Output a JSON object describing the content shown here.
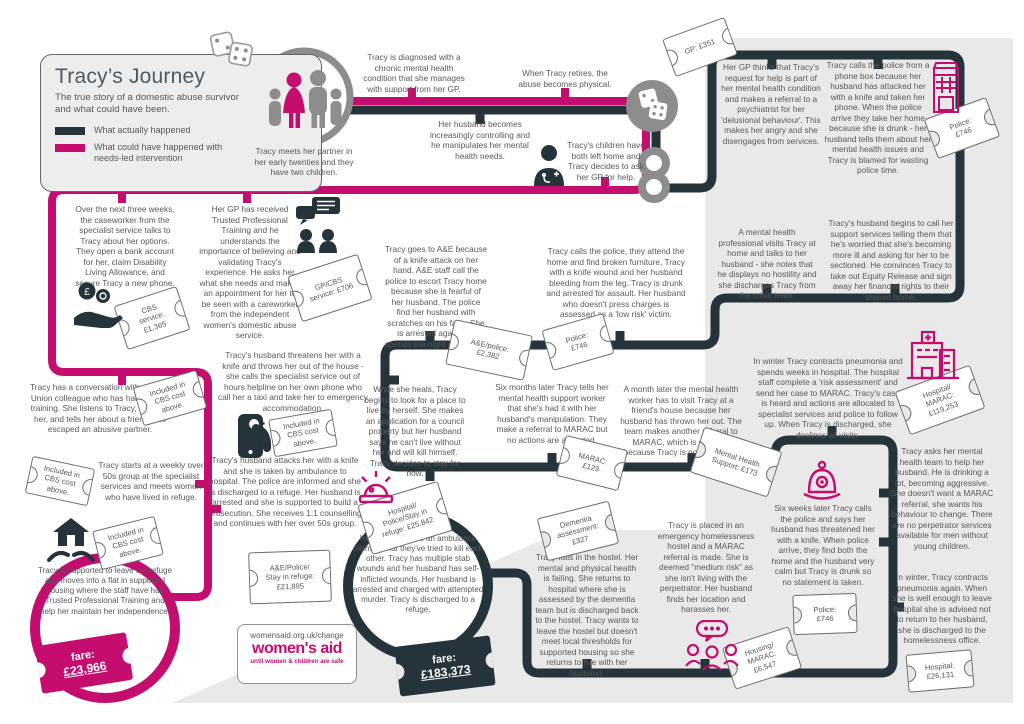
{
  "colors": {
    "dark": "#25333b",
    "pink": "#c40d6f",
    "gray": "#8d8d8d",
    "panel": "#e9e9e9",
    "text": "#57585a"
  },
  "header": {
    "title": "Tracy’s Journey",
    "subtitle": "The true story of a domestic abuse survivor and what could have been.",
    "legend": [
      {
        "label": "What actually happened",
        "color": "#25333b"
      },
      {
        "label": "What could have happened with needs-led intervention",
        "color": "#c40d6f"
      }
    ]
  },
  "story": {
    "meet": "Tracy meets her partner in her early twenties and they have two children.",
    "diagnosed": "Tracy is diagnosed with a chronic mental health condition that she manages with support from her GP.",
    "retires": "When Tracy retires, the abuse becomes physical.",
    "controlling": "Her husband becomes increasingly controlling and he manipulates her mental health needs.",
    "children_left": "Tracy's children have both left home and Tracy decides to ask her GP for help.",
    "gp_thinks": "Her GP thinks that Tracy's request for help is part of her mental health condition and makes a referral to a psychiatrist for her 'delusional behaviour'. This makes her angry and she disengages from services.",
    "phone_box": "Tracy calls the police from a phone box because her husband has attacked her with a knife and taken her phone. When the police arrive they take her home because she is drunk - her husband tells them about her mental health issues and Tracy is blamed for wasting police time.",
    "mh_professional": "A mental health professional visits Tracy at home and talks to her husband - she notes that he displays no hostility and she discharges Tracy from the crisis team.",
    "husband_calls": "Tracy's husband begins to call her support services telling them that he's worried that she's becoming more ill and asking for her to be sectioned. He convinces Tracy to take out Equity Release and sign away her financial rights to their shared home.",
    "caseworker": "Over the next three weeks, the caseworker from the specialist service talks to Tracy about her options. They open a bank account for her, claim Disability Living Allowance, and secure Tracy a new phone.",
    "gp_trained": "Her GP has received Trusted Professional Training and he understands the importance of believing and validating Tracy's experience. He asks her what she needs and makes an appointment for her to be seen with a careworker from the independent women's domestic abuse service.",
    "ae_knife": "Tracy goes to A&E because of a knife attack on her hand. A&E staff call the police to escort Tracy home because she is fearful of her husband. The police find her husband with scratches on his face. She is arrested again and spends the night in custody.",
    "police_attend": "Tracy calls the police, they attend the home and find broken furniture, Tracy with a knife wound and her husband bleeding from the leg. Tracy is drunk and arrested for assault. Her husband who doesn't press charges is assessed as a 'low risk' victim.",
    "winter_pneumonia": "In winter Tracy contracts pneumonia and spends weeks in hospital. The hospital staff complete a 'risk assessment' and send her case to MARAC. Tracy's case is heard and actions are allocated to specialist services and police to follow up. When Tracy is discharged, she declines all visits.",
    "trade_union": "Tracy has a conversation with a Trade Union colleague who has had Ask Me training. She listens to Tracy, believes her, and tells her about a friend who escaped an abusive partner.",
    "over_50s": "Tracy starts at a weekly over 50s group at the specialist services and meets women who have lived in refuge.",
    "threatens": "Tracy's husband threatens her with a knife and throws her out of the house - she calls the specialist service out of hours helpline on her own phone who call her a taxi and take her to emergency accommodation.",
    "attacks": "Tracy's husband attacks her with a knife and she is taken by ambulance to hospital. The police are informed and she is discharged to a refuge. Her husband is arrested and she is supported to build a prosecution. She receives 1:1 counselling and continues with her over 50s group.",
    "heals": "While she heals, Tracy begins to look for a place to live by herself. She makes an application for a council property but her husband says he can't live without her and will kill himself. Tracy decides to stay for now.",
    "six_months": "Six months later Tracy tells her mental health support worker that she's had it with her husband's manipulation. They make a referral to MARAC but no actions are allocated.",
    "month_later": "A month later the mental health worker has to visit Tracy at a friend's house because her husband has thrown her out. The team makes another referral to MARAC, which is declined because Tracy is not 'high risk'.",
    "mh_help": "Tracy asks her mental health team to help her husband. He is drinking a lot, becoming aggressive. She doesn't want a MARAC referral, she wants his behaviour to change. There are no perpetrator services available for men without young children.",
    "supported_leave": "Tracy is supported to leave the refuge and moves into a flat in supported housing where the staff have had Trusted Professional Training and help her maintain her independence.",
    "ambulance": "Her husband calls an ambulance claiming that they've tried to kill each other. Tracy has multiple stab wounds and her husband has self-inflicted wounds. Her husband is arrested and charged with attempted murder. Tracy is discharged to a refuge.",
    "falls_hostel": "Tracy falls in the hostel. Her mental and physical health is failing. She returns to hospital where she is assessed by the dementia team but is discharged back to the hostel. Tracy wants to leave the hostel but doesn't meet local thresholds for supported housing so she returns to live with her husband.",
    "emergency_hostel": "Tracy is placed in an emergency homelessness hostel and a MARAC referral is made. She is deemed \"medium risk\" as she isn't living with the perpetrator. Her husband finds her location and harasses her.",
    "six_weeks": "Six weeks later Tracy calls the police and says her husband has threatened her with a knife. When police arrive, they find both the home and the husband very calm but Tracy is drunk so no statement is taken.",
    "winter_again": "In winter, Tracy contracts pneumonia again. When she is well enough to leave hospital she is advised not to return to her husband, she is discharged to the homelessness office."
  },
  "tickets": {
    "gp": "GP: £351",
    "police_top": "Police: £746",
    "cbs": "CBS service: £1,365",
    "gp_cbs": "GP/CBS service: £706",
    "ae_police": "A&E/police: £2,382",
    "police_mid": "Police: £746",
    "marac": "MARAC: £129",
    "mh_support": "Mental Health Support: £173",
    "hospital_marac": "Hospital/ MARAC: £119,253",
    "included": "Included in CBS cost above.",
    "ae_police_refuge": "A&E/Police/ Stay in refuge: £21,895",
    "hospital_police_refuge": "Hospital/ Police/Stay in refuge: £25,842",
    "dementia": "Dementia assessment: £327",
    "housing_marac": "Housing/ MARAC: £6,547",
    "police_bottom": "Police: £746",
    "hospital": "Hospital: £26,131"
  },
  "fares": {
    "could_route": {
      "label": "fare:",
      "amount": "£23,966"
    },
    "actual_route": {
      "label": "fare:",
      "amount": "£183,373"
    }
  },
  "logo": {
    "url": "womensaid.org.uk/change",
    "name": "women's aid",
    "tagline": "until women & children are safe"
  }
}
